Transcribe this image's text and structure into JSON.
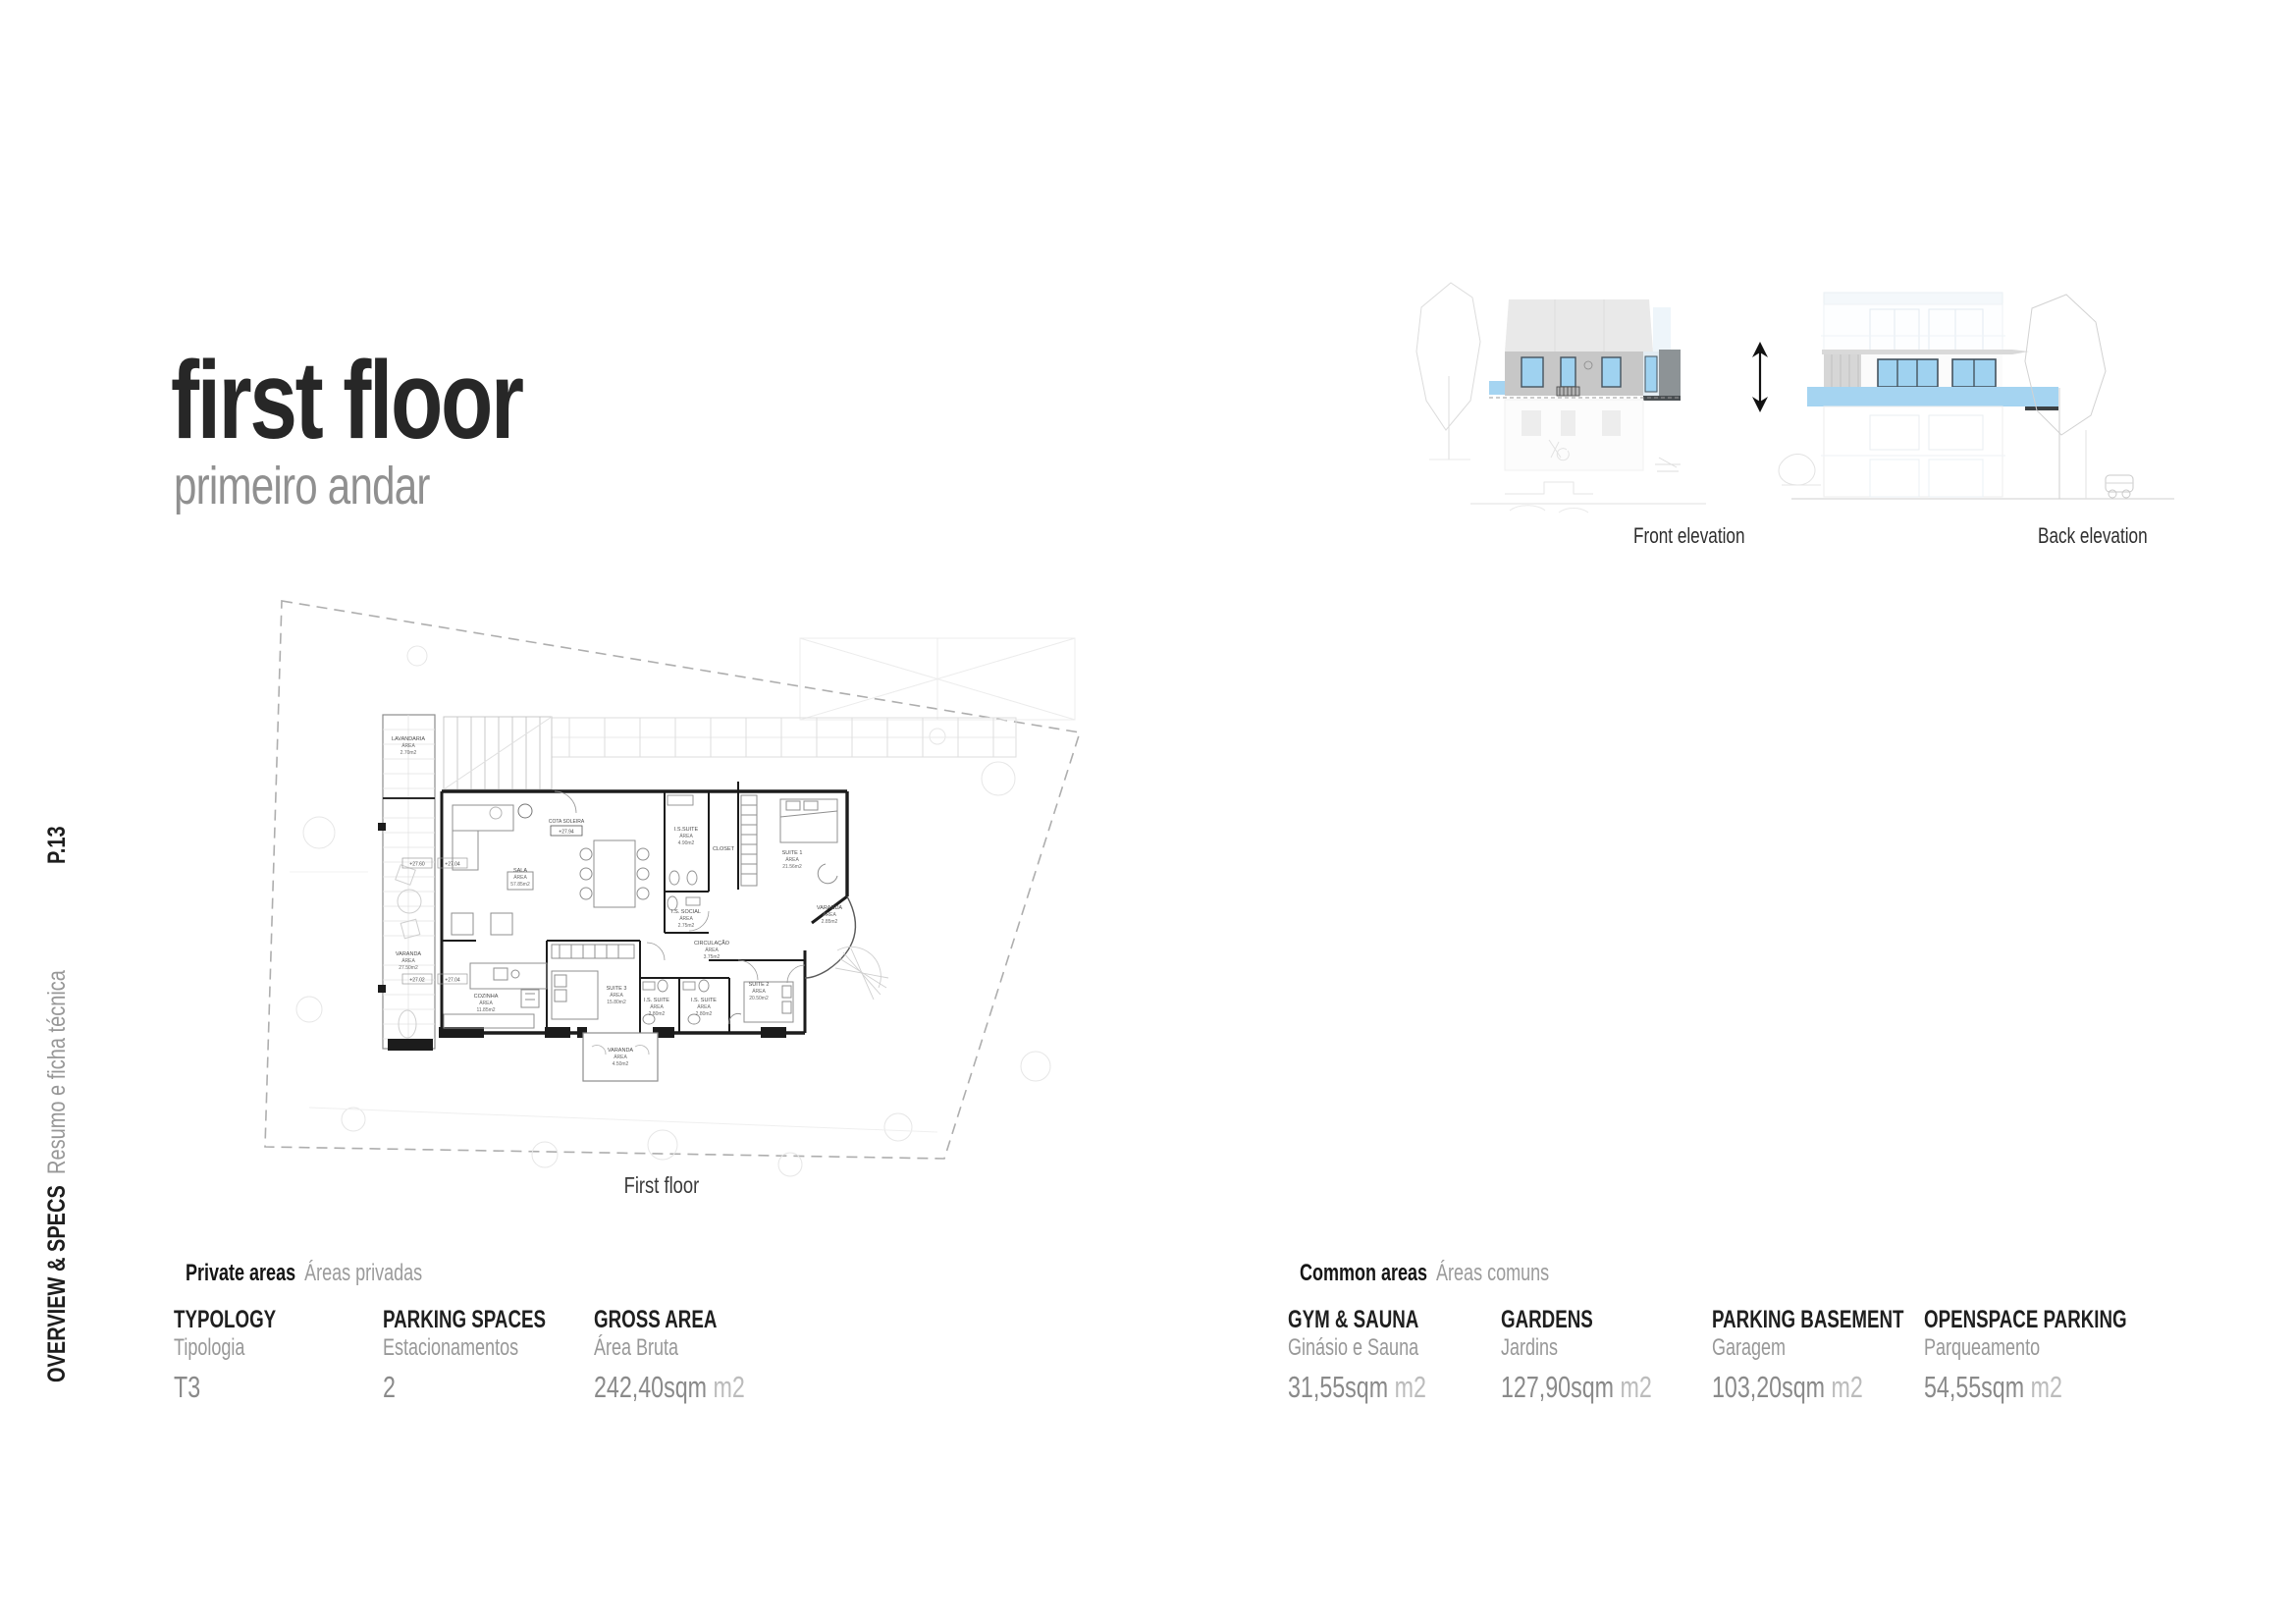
{
  "page": {
    "number": "P.13",
    "section_title": "OVERVIEW & SPECS",
    "section_subtitle": "Resumo e ficha técnica"
  },
  "header": {
    "title": "first floor",
    "subtitle": "primeiro andar"
  },
  "elevations": {
    "front_label": "Front elevation",
    "back_label": "Back elevation"
  },
  "floor_plan": {
    "caption": "First floor",
    "area_word": "ÁREA",
    "rooms": [
      {
        "name": "LAVANDARIA",
        "area": "2.70m2"
      },
      {
        "name": "VARANDA",
        "area": "27.50m2"
      },
      {
        "name": "SALA",
        "area": "57.85m2"
      },
      {
        "name": "COZINHA",
        "area": "11.85m2"
      },
      {
        "name": "SUITE 3",
        "area": "15.80m2"
      },
      {
        "name": "I.S. SUITE",
        "area": "2.80m2"
      },
      {
        "name": "I.S. SUITE",
        "area": "2.80m2"
      },
      {
        "name": "SUITE 2",
        "area": "20.50m2"
      },
      {
        "name": "SUITE 1",
        "area": "21.56m2"
      },
      {
        "name": "I.S.SUITE",
        "area": "4.90m2"
      },
      {
        "name": "I.S. SOCIAL",
        "area": "2.75m2"
      },
      {
        "name": "CIRCULAÇÃO",
        "area": "3.75m2"
      },
      {
        "name": "VARANDA",
        "area": "2.85m2"
      },
      {
        "name": "VARANDA",
        "area": "4.50m2"
      },
      {
        "name": "CLOSET",
        "area": ""
      }
    ],
    "markers": {
      "cota_label": "COTA SOLEIRA",
      "cota_value": "+27.94",
      "level_a": "+27.60",
      "level_b": "+27.04",
      "level_c": "+27.02",
      "level_d": "+27.04"
    }
  },
  "specs": {
    "private": {
      "title": "Private areas",
      "subtitle": "Áreas privadas",
      "items": [
        {
          "label": "TYPOLOGY",
          "sublabel": "Tipologia",
          "value": "T3",
          "unit": ""
        },
        {
          "label": "PARKING SPACES",
          "sublabel": "Estacionamentos",
          "value": "2",
          "unit": ""
        },
        {
          "label": "GROSS AREA",
          "sublabel": "Área Bruta",
          "value": "242,40sqm",
          "unit": "m2"
        }
      ]
    },
    "common": {
      "title": "Common areas",
      "subtitle": "Áreas comuns",
      "items": [
        {
          "label": "GYM & SAUNA",
          "sublabel": "Ginásio e Sauna",
          "value": "31,55sqm",
          "unit": "m2"
        },
        {
          "label": "GARDENS",
          "sublabel": "Jardins",
          "value": "127,90sqm",
          "unit": "m2"
        },
        {
          "label": "PARKING BASEMENT",
          "sublabel": "Garagem",
          "value": "103,20sqm",
          "unit": "m2"
        },
        {
          "label": "OPENSPACE PARKING",
          "sublabel": "Parqueamento",
          "value": "54,55sqm",
          "unit": "m2"
        }
      ]
    }
  },
  "colors": {
    "accent_blue": "#a5d4f1",
    "window_blue": "#9fd2f0",
    "floor_gray": "#c7c7c7",
    "dark_volume": "#8d9396",
    "text_dark": "#262626",
    "text_gray": "#8f8f8f"
  }
}
